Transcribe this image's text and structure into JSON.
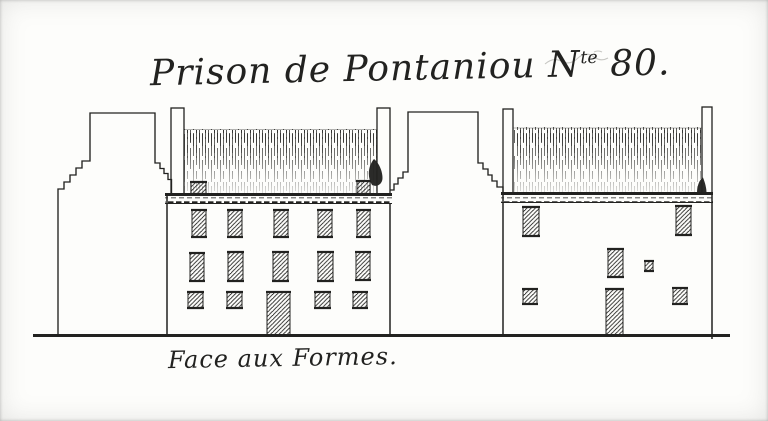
{
  "colors": {
    "ink": "#222220",
    "paper": "#fdfdfb"
  },
  "title": {
    "main": "Prison de Pontaniou ",
    "n": "N",
    "sup": "te",
    "num": " 80."
  },
  "caption": "Face aux Formes.",
  "drawing": {
    "subject": "two prison building elevations with stepped gables",
    "ground": {
      "x1": 33,
      "x2": 730,
      "y": 335.5
    },
    "openings": [
      {
        "building": "left",
        "kind": "roof-box",
        "x": 191,
        "y": 182,
        "w": 15,
        "h": 12
      },
      {
        "building": "left",
        "kind": "roof-box",
        "x": 357,
        "y": 181,
        "w": 13,
        "h": 13
      },
      {
        "building": "left",
        "kind": "window",
        "x": 192,
        "y": 210,
        "w": 14,
        "h": 27
      },
      {
        "building": "left",
        "kind": "window",
        "x": 228,
        "y": 210,
        "w": 14,
        "h": 27
      },
      {
        "building": "left",
        "kind": "window",
        "x": 274,
        "y": 210,
        "w": 14,
        "h": 27
      },
      {
        "building": "left",
        "kind": "window",
        "x": 318,
        "y": 210,
        "w": 14,
        "h": 27
      },
      {
        "building": "left",
        "kind": "window",
        "x": 357,
        "y": 210,
        "w": 13,
        "h": 27
      },
      {
        "building": "left",
        "kind": "window",
        "x": 190,
        "y": 253,
        "w": 14,
        "h": 28
      },
      {
        "building": "left",
        "kind": "window",
        "x": 228,
        "y": 252,
        "w": 15,
        "h": 29
      },
      {
        "building": "left",
        "kind": "window",
        "x": 273,
        "y": 252,
        "w": 15,
        "h": 29
      },
      {
        "building": "left",
        "kind": "window",
        "x": 318,
        "y": 252,
        "w": 15,
        "h": 29
      },
      {
        "building": "left",
        "kind": "window",
        "x": 356,
        "y": 252,
        "w": 14,
        "h": 28
      },
      {
        "building": "left",
        "kind": "small-window",
        "x": 188,
        "y": 292,
        "w": 15,
        "h": 16
      },
      {
        "building": "left",
        "kind": "small-window",
        "x": 227,
        "y": 292,
        "w": 15,
        "h": 16
      },
      {
        "building": "left",
        "kind": "door",
        "x": 267,
        "y": 292,
        "w": 23,
        "h": 43
      },
      {
        "building": "left",
        "kind": "small-window",
        "x": 315,
        "y": 292,
        "w": 15,
        "h": 16
      },
      {
        "building": "left",
        "kind": "small-window",
        "x": 353,
        "y": 292,
        "w": 14,
        "h": 16
      },
      {
        "building": "right",
        "kind": "window",
        "x": 523,
        "y": 207,
        "w": 16,
        "h": 29
      },
      {
        "building": "right",
        "kind": "window",
        "x": 676,
        "y": 206,
        "w": 15,
        "h": 29
      },
      {
        "building": "right",
        "kind": "window",
        "x": 608,
        "y": 249,
        "w": 15,
        "h": 28
      },
      {
        "building": "right",
        "kind": "small-window",
        "x": 645,
        "y": 261,
        "w": 8,
        "h": 10
      },
      {
        "building": "right",
        "kind": "small-window",
        "x": 523,
        "y": 289,
        "w": 14,
        "h": 15
      },
      {
        "building": "right",
        "kind": "door",
        "x": 606,
        "y": 289,
        "w": 17,
        "h": 46
      },
      {
        "building": "right",
        "kind": "small-window",
        "x": 673,
        "y": 288,
        "w": 14,
        "h": 16
      }
    ]
  }
}
